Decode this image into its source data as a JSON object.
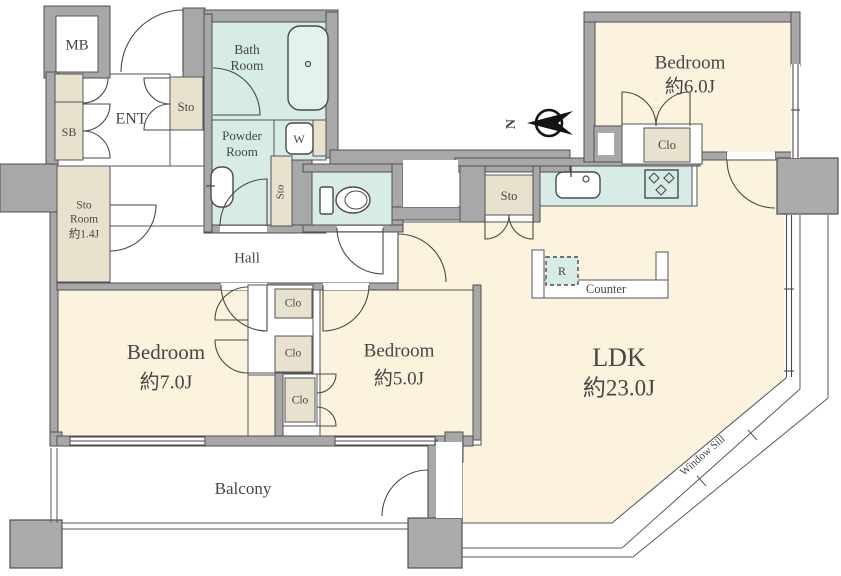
{
  "plan": {
    "type": "apartment-floor-plan",
    "rooms": {
      "mb": {
        "label": "MB"
      },
      "entrance": {
        "label": "ENT"
      },
      "shoe_box": {
        "label": "SB"
      },
      "entrance_storage": {
        "label": "Sto"
      },
      "bathroom": {
        "line1": "Bath",
        "line2": "Room"
      },
      "powder_room": {
        "line1": "Powder",
        "line2": "Room"
      },
      "washer": {
        "label": "W"
      },
      "powder_storage": {
        "label": "Sto"
      },
      "storage_room": {
        "line1": "Sto",
        "line2": "Room",
        "line3": "約1.4J"
      },
      "hall": {
        "label": "Hall"
      },
      "bedroom_6j": {
        "line1": "Bedroom",
        "line2": "約6.0J"
      },
      "bedroom_6j_closet": {
        "label": "Clo"
      },
      "kitchen_storage": {
        "label": "Sto"
      },
      "ldk": {
        "line1": "LDK",
        "line2": "約23.0J"
      },
      "refrigerator": {
        "label": "R"
      },
      "kitchen_counter": {
        "label": "Counter"
      },
      "bedroom_7j": {
        "line1": "Bedroom",
        "line2": "約7.0J"
      },
      "bedroom_7j_closet_upper": {
        "label": "Clo"
      },
      "bedroom_7j_closet_lower": {
        "label": "Clo"
      },
      "bedroom_5j_closet": {
        "label": "Clo"
      },
      "bedroom_5j": {
        "line1": "Bedroom",
        "line2": "約5.0J"
      },
      "balcony": {
        "label": "Balcony"
      },
      "window_sill": {
        "label": "Window Sill"
      },
      "compass": {
        "label": "N"
      }
    },
    "colors": {
      "wall_gray": "#a8a8a8",
      "floor_cream": "#fbf3de",
      "wet_area_cyan": "#d7ebe7",
      "storage_tan": "#e7e1cd",
      "line_dark": "#4a4a4a",
      "background": "#ffffff"
    }
  }
}
